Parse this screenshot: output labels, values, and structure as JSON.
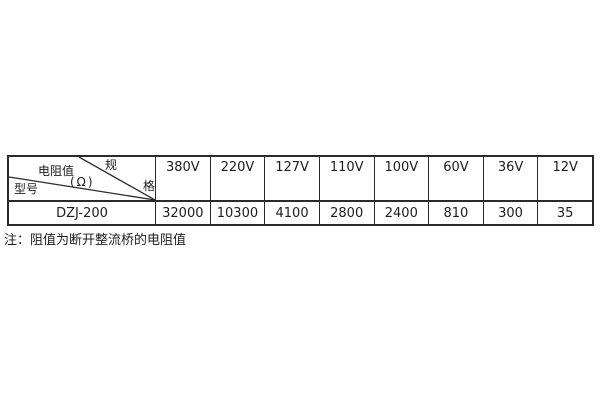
{
  "colors": {
    "border": "#2b2b2b",
    "text": "#1d1d1d",
    "background": "#ffffff"
  },
  "table": {
    "header": {
      "corner": {
        "spec_char_top": "规",
        "spec_char_bottom": "格",
        "resistance_label": "电阻值",
        "resistance_unit": "(Ω)",
        "model_label": "型号"
      },
      "voltage_columns": [
        "380V",
        "220V",
        "127V",
        "110V",
        "100V",
        "60V",
        "36V",
        "12V"
      ]
    },
    "body": {
      "model": "DZJ-200",
      "values": [
        "32000",
        "10300",
        "4100",
        "2800",
        "2400",
        "810",
        "300",
        "35"
      ]
    }
  },
  "note": "注：阻值为断开整流桥的电阻值",
  "chart_data": {
    "type": "table",
    "corner_labels": {
      "top_right": "规格",
      "middle": "电阻值(Ω)",
      "bottom_left": "型号"
    },
    "columns": [
      "380V",
      "220V",
      "127V",
      "110V",
      "100V",
      "60V",
      "36V",
      "12V"
    ],
    "rows": [
      {
        "model": "DZJ-200",
        "values": [
          32000,
          10300,
          4100,
          2800,
          2400,
          810,
          300,
          35
        ]
      }
    ],
    "note": "注：阻值为断开整流桥的电阻值"
  }
}
